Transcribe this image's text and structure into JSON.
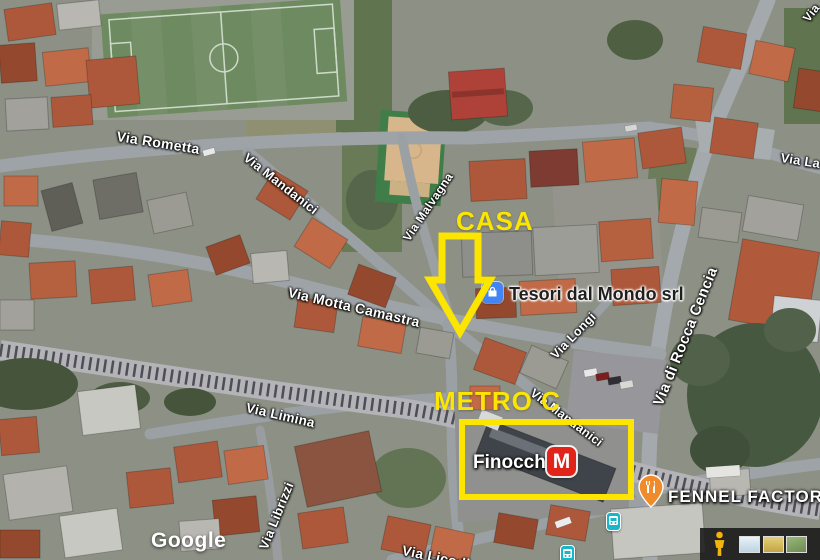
{
  "map": {
    "attribution": {
      "logo": "Google"
    },
    "streets": [
      {
        "name": "Via Rometta"
      },
      {
        "name": "Via Mandanici"
      },
      {
        "name": "Via Malvagna"
      },
      {
        "name": "Via Motta Camastra"
      },
      {
        "name": "Via Longi"
      },
      {
        "name": "Via di Rocca Cencia"
      },
      {
        "name": "Via Mandanici"
      },
      {
        "name": "Via Limina"
      },
      {
        "name": "Via Librizzi"
      },
      {
        "name": "Via Licodia Eu"
      },
      {
        "name": "Via La"
      },
      {
        "name": "Via"
      }
    ],
    "pois": [
      {
        "name": "Tesori dal Mondo srl"
      },
      {
        "name": "Finocchio",
        "logo": "M"
      },
      {
        "name": "FENNEL FACTORY"
      }
    ],
    "annotations": {
      "casa": "CASA",
      "metro": "METRO C"
    },
    "colors": {
      "highlight": "#fce500",
      "metro_logo": "#e2231a",
      "shop_icon": "#4285f4",
      "restaurant_pin": "#ef8b2a",
      "transit_icon": "#19b5c8"
    }
  }
}
